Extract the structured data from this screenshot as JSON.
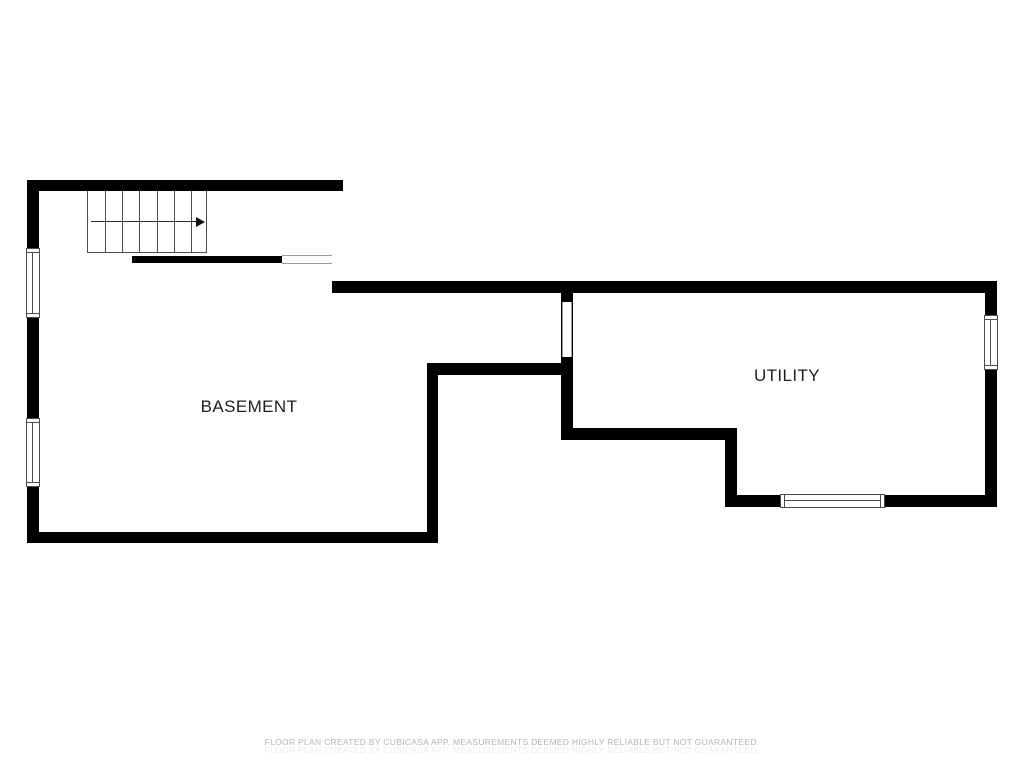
{
  "rooms": [
    {
      "name": "BASEMENT",
      "label_x": 249,
      "label_y": 407
    },
    {
      "name": "UTILITY",
      "label_x": 787,
      "label_y": 376
    }
  ],
  "footer": {
    "line1": "FLOOR PLAN CREATED BY CUBICASA APP. MEASUREMENTS DEEMED HIGHLY RELIABLE BUT NOT GUARANTEED.",
    "line2": "FLOOR PLAN CREATED BY CUBICASA APP. MEASUREMENTS DEEMED HIGHLY RELIABLE BUT NOT GUARANTEED."
  },
  "colors": {
    "wall": "#000000",
    "stair_line": "#4d4d4d",
    "window_frame": "#4b4b4b",
    "opening_line": "#9c9c9c",
    "label_text": "#1e1e1e",
    "footer_text": "#b5b5b5"
  },
  "floor_plan": {
    "walls": [
      {
        "name": "basement-top-wall",
        "x": 28,
        "y": 180,
        "w": 315,
        "h": 11
      },
      {
        "name": "basement-left-wall",
        "x": 27,
        "y": 180,
        "w": 12,
        "h": 363
      },
      {
        "name": "basement-bottom-wall",
        "x": 28,
        "y": 532,
        "w": 410,
        "h": 11
      },
      {
        "name": "basement-right-wall",
        "x": 427,
        "y": 363,
        "w": 11,
        "h": 180
      },
      {
        "name": "basement-utility-divider-wall",
        "x": 427,
        "y": 363,
        "w": 146,
        "h": 12
      },
      {
        "name": "utility-entry-wall",
        "x": 561,
        "y": 293,
        "w": 12,
        "h": 147
      },
      {
        "name": "utility-top-wall",
        "x": 332,
        "y": 281,
        "w": 665,
        "h": 12
      },
      {
        "name": "utility-right-wall",
        "x": 985,
        "y": 281,
        "w": 12,
        "h": 226
      },
      {
        "name": "utility-step-wall-h",
        "x": 561,
        "y": 428,
        "w": 176,
        "h": 12
      },
      {
        "name": "utility-step-wall-v",
        "x": 725,
        "y": 428,
        "w": 12,
        "h": 79
      },
      {
        "name": "utility-bottom-wall",
        "x": 725,
        "y": 495,
        "w": 272,
        "h": 12
      },
      {
        "name": "understair-wall",
        "x": 132,
        "y": 256,
        "w": 150,
        "h": 7
      }
    ],
    "windows": [
      {
        "name": "window-left-upper",
        "x": 26,
        "y": 248,
        "w": 14,
        "h": 70,
        "orient": "v"
      },
      {
        "name": "window-left-lower",
        "x": 26,
        "y": 418,
        "w": 14,
        "h": 69,
        "orient": "v"
      },
      {
        "name": "window-right",
        "x": 984,
        "y": 315,
        "w": 14,
        "h": 55,
        "orient": "v"
      },
      {
        "name": "window-bottom",
        "x": 780,
        "y": 494,
        "w": 105,
        "h": 14,
        "orient": "h"
      }
    ],
    "openings": [
      {
        "name": "opening-under-stairs",
        "x": 282,
        "y": 255,
        "w": 50,
        "h": 9,
        "orient": "h"
      },
      {
        "name": "opening-utility-door",
        "x": 562,
        "y": 302,
        "w": 10,
        "h": 55,
        "orient": "v"
      }
    ],
    "stairs": {
      "x": 87,
      "y": 191,
      "w": 120,
      "h": 62,
      "treads": 7,
      "direction": "right"
    }
  }
}
